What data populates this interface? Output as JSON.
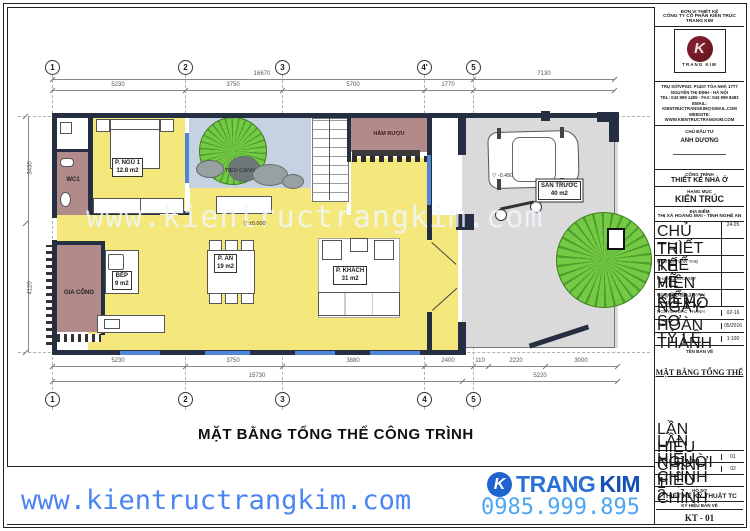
{
  "plan": {
    "title": "MẶT BẰNG TỔNG THỂ CÔNG TRÌNH",
    "watermark": "www.kientructrangkim.com",
    "rooms": {
      "wc": "WC1",
      "bedroom": "P. NGỦ 1",
      "bedroom_area": "12.8 m2",
      "garden": "TIỂU CẢNH",
      "wine": "HẦM RƯỢU",
      "kitchen": "BẾP",
      "kitchen_area": "9 m2",
      "dining": "P. ĂN",
      "dining_area": "19 m2",
      "living": "P. KHÁCH",
      "living_area": "31 m2",
      "work": "GIA CÔNG",
      "yard": "SÂN TRƯỚC",
      "yard_area": "40 m2"
    },
    "levels": {
      "zero": "±0.000",
      "yard": "-0.450"
    },
    "grid": {
      "top": [
        "1",
        "2",
        "3",
        "4'",
        "5"
      ],
      "bottom": [
        "1",
        "2",
        "3",
        "4",
        "5"
      ]
    },
    "dims": {
      "top_total": "16670",
      "top_right": "7130",
      "top_segments": [
        "5230",
        "3750",
        "5700",
        "1770"
      ],
      "bottom_segments": [
        "5230",
        "3750",
        "3880",
        "2400",
        "110",
        "2220",
        "3000"
      ],
      "bottom_totals": [
        "15730",
        "5220"
      ],
      "left": [
        "3430",
        "4120"
      ]
    }
  },
  "title_block": {
    "unit_label": "ĐƠN VỊ THIẾT KẾ",
    "company": "CÔNG TY CỔ PHẦN KIẾN TRÚC TRANG KIM",
    "logo_k": "K",
    "logo_text": "TRANG KIM",
    "address_lines": [
      "TRỤ SỞ/VPGD: P1407 TÒA NHÀ 17T7",
      "NGUYỄN THỊ ĐỊNH - HÀ NỘI",
      "TEL: 043 999 1485 - FAX: 043 999 8483",
      "EMAIL: KIENTRUCTRANGKIM@GMAIL.COM",
      "WEBSITE: WWW.KIENTRUCTRANGKIM.COM"
    ],
    "investor_label": "CHỦ ĐẦU TƯ",
    "investor": "ANH DƯƠNG",
    "project_label": "CÔNG TRÌNH",
    "project": "THIẾT KẾ NHÀ Ở",
    "category_label": "HẠNG MỤC",
    "category": "KIẾN TRÚC",
    "location_label": "ĐỊA ĐIỂM",
    "location": "THỊ XÃ HOÀNG MAI - TỈNH NGHỆ AN",
    "staff": [
      {
        "role": "CHỦ TRÌ",
        "name": "NGUYỄN VĂN THỌ",
        "note": "24.05"
      },
      {
        "role": "THIẾT KẾ",
        "name": "PHAN QUỐC VIỆT",
        "note": ""
      },
      {
        "role": "THỂ HIỆN",
        "name": "VŨ QUỐC OANH",
        "note": ""
      },
      {
        "role": "VẼ",
        "name": "NGUYỄN ĐẮC THẠNH",
        "note": ""
      },
      {
        "role": "KIỂM",
        "name": "NGUYỄN ĐẮC THẠNH",
        "note": ""
      }
    ],
    "doc_no_label": "SỐ HỒ SƠ",
    "doc_no": "02-16",
    "date_label": "NGÀY HOÀN THÀNH",
    "date": "05/2016",
    "scale_label": "TỶ LỆ",
    "scale": "1:100",
    "drawing_name_label": "TÊN BẢN VẼ",
    "drawing_name": "MẶT BẰNG TỔNG THỂ",
    "revisions": [
      {
        "label": "LẦN HIỆU CHỈNH 1",
        "value": "01"
      },
      {
        "label": "LẦN HIỆU CHỈNH 2",
        "value": "02"
      },
      {
        "label": "NGƯỜI HIỆU CHỈNH",
        "value": ""
      }
    ],
    "dossier_label": "HỒ SƠ",
    "dossier": "THIẾT KẾ KỸ THUẬT TC",
    "code_label": "KÝ HIỆU BẢN VẼ",
    "code": "KT - 01"
  },
  "footer": {
    "url": "www.kientructrangkim.com",
    "brand_1": "TRANG",
    "brand_2": "KIM",
    "brand_k": "K",
    "phone": "0985.999.895"
  },
  "colors": {
    "accent_blue": "#4b86f0",
    "room_yellow": "#f4e87d",
    "room_mauve": "#b18a8a",
    "wall_navy": "#262e42"
  }
}
